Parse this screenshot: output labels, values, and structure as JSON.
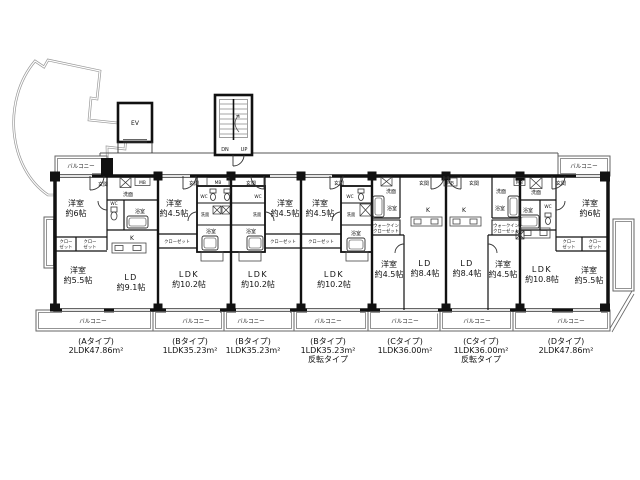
{
  "labels": {
    "ev": "EV",
    "dn": "DN",
    "up": "UP",
    "balcony": "バルコニー",
    "entrance": "玄関",
    "wash": "洗面",
    "bath": "浴室",
    "wc": "WC",
    "kitchen": "K",
    "mb": "MB",
    "closet": "クローゼット",
    "closet_top": "クロー",
    "closet_bottom": "ゼット",
    "wic_top": "ウォークイン",
    "wic_bottom": "クローゼット"
  },
  "rooms": {
    "a": {
      "bed1": [
        "洋室",
        "約6帖"
      ],
      "bed2": [
        "洋室",
        "約5.5帖"
      ],
      "living": [
        "LD",
        "約9.1帖"
      ]
    },
    "b1": {
      "bed": [
        "洋室",
        "約4.5帖"
      ],
      "living": [
        "LDK",
        "約10.2帖"
      ]
    },
    "b2": {
      "bed": [
        "洋室",
        "約4.5帖"
      ],
      "living": [
        "LDK",
        "約10.2帖"
      ]
    },
    "b3": {
      "bed": [
        "洋室",
        "約4.5帖"
      ],
      "living": [
        "LDK",
        "約10.2帖"
      ]
    },
    "c1": {
      "bed": [
        "洋室",
        "約4.5帖"
      ],
      "living": [
        "LD",
        "約8.4帖"
      ]
    },
    "c2": {
      "bed": [
        "洋室",
        "約4.5帖"
      ],
      "living": [
        "LD",
        "約8.4帖"
      ]
    },
    "d": {
      "bed1": [
        "洋室",
        "約6帖"
      ],
      "bed2": [
        "洋室",
        "約5.5帖"
      ],
      "living": [
        "LDK",
        "約10.8帖"
      ]
    }
  },
  "types": [
    {
      "name": "(Aタイプ)",
      "area": "2LDK47.86m²",
      "note": ""
    },
    {
      "name": "(Bタイプ)",
      "area": "1LDK35.23m²",
      "note": ""
    },
    {
      "name": "(Bタイプ)",
      "area": "1LDK35.23m²",
      "note": ""
    },
    {
      "name": "(Bタイプ)",
      "area": "1LDK35.23m²",
      "note": "反転タイプ"
    },
    {
      "name": "(Cタイプ)",
      "area": "1LDK36.00m²",
      "note": ""
    },
    {
      "name": "(Cタイプ)",
      "area": "1LDK36.00m²",
      "note": "反転タイプ"
    },
    {
      "name": "(Dタイプ)",
      "area": "2LDK47.86m²",
      "note": ""
    }
  ]
}
